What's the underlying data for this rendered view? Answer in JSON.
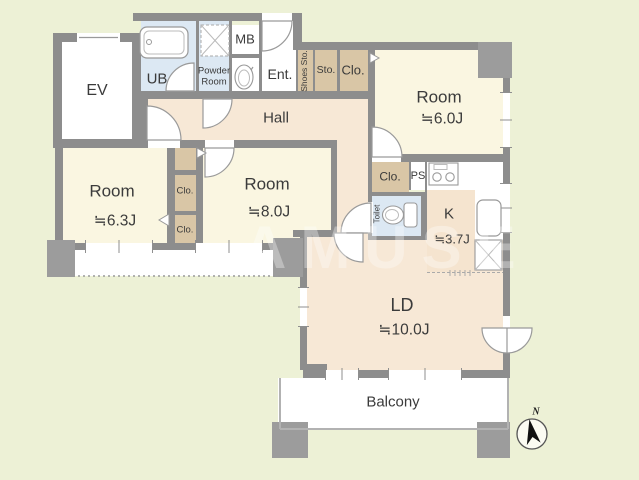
{
  "plan": {
    "background": "#edf1d6",
    "colors": {
      "wall": "#8d8d8d",
      "pillar": "#9c9c9c",
      "room_floor": "#faf6e1",
      "hall_floor": "#f7e8d6",
      "closet_floor": "#d9c6a6",
      "wet_floor": "#dce8f3",
      "balcony_floor": "#ffffff",
      "outline": "#999999"
    },
    "labels": {
      "ev": "EV",
      "ub": "UB",
      "powder_room": "Powder Room",
      "mb": "MB",
      "ent": "Ent.",
      "shoes_sto": "Shoes Sto.",
      "sto": "Sto.",
      "clo": "Clo.",
      "hall": "Hall",
      "ps": "PS",
      "toilet": "Toilet",
      "balcony": "Balcony",
      "north": "N",
      "watermark": "AMUSE"
    },
    "rooms": {
      "room_west": {
        "name": "Room",
        "area": "≒6.3J"
      },
      "room_center": {
        "name": "Room",
        "area": "≒8.0J"
      },
      "room_east": {
        "name": "Room",
        "area": "≒6.0J"
      },
      "kitchen": {
        "name": "K",
        "area": "≒3.7J"
      },
      "living_dining": {
        "name": "LD",
        "area": "≒10.0J"
      }
    },
    "icons": [
      "bathtub-icon",
      "washbasin-icon",
      "laundry-space-icon",
      "toilet-icon",
      "stove-icon",
      "sink-icon",
      "refrigerator-space-icon",
      "compass-icon"
    ]
  }
}
